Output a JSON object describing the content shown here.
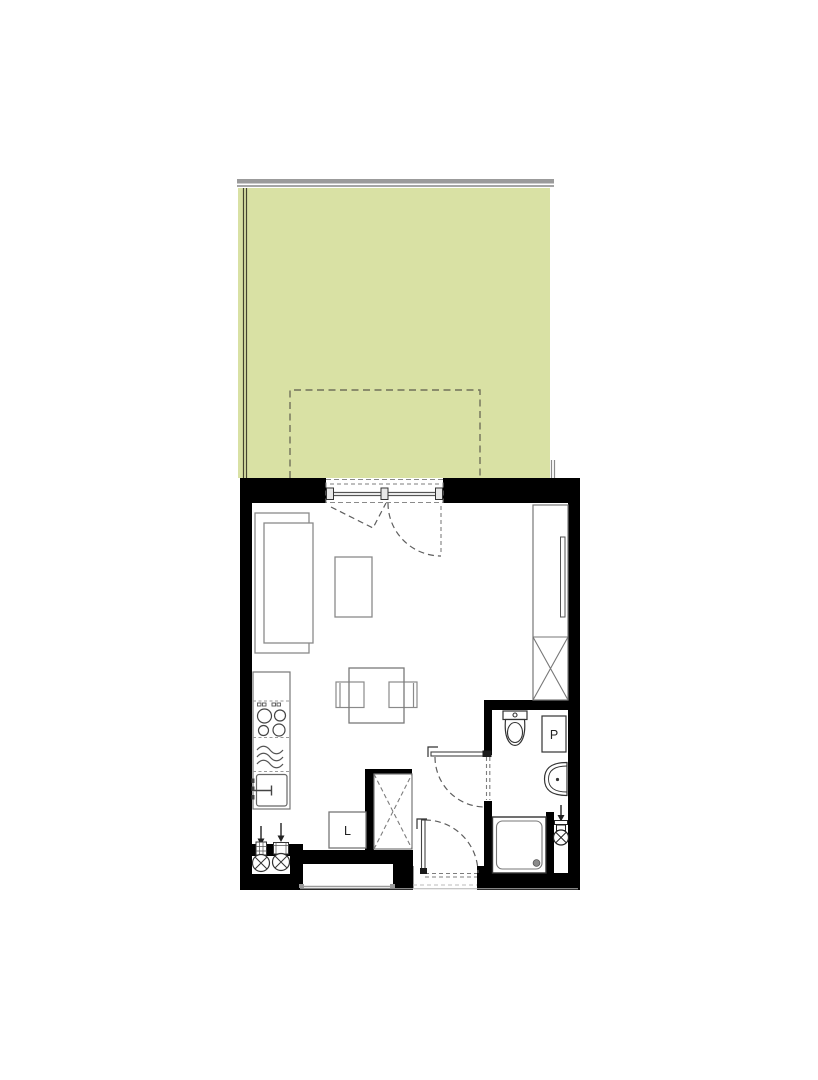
{
  "labels": {
    "fridge": "L",
    "washing_machine": "P"
  },
  "colors": {
    "garden": "#d9e1a4",
    "wall": "#000000",
    "boundary_bar": "#9b9b9b",
    "fence_line": "#45452f",
    "furniture_line": "#7a7a7a"
  },
  "symbols": {
    "wardrobe": "crossed-box",
    "hob": "four-burner-circles",
    "heater": "triple-wave",
    "water_connection": "circle-with-cross-and-down-arrow",
    "door_swing": "dashed-quarter-arc"
  }
}
